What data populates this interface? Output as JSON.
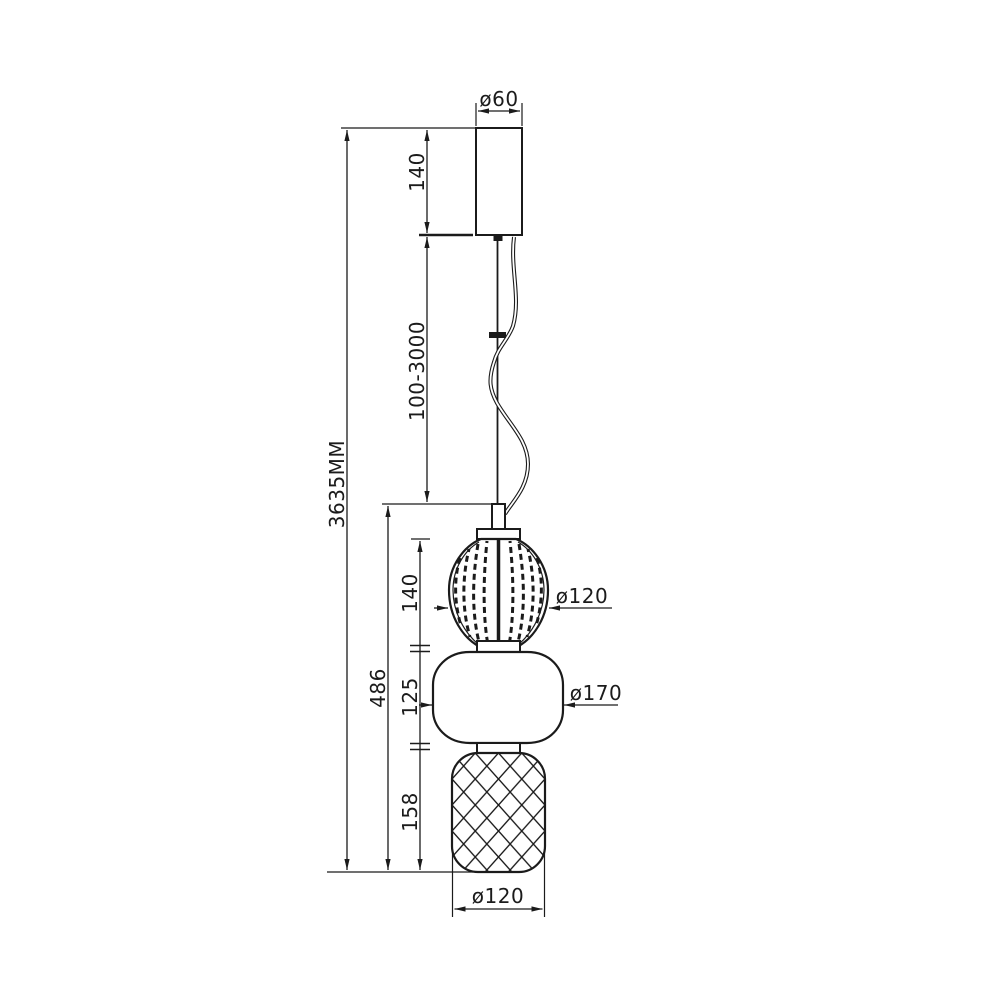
{
  "drawing": {
    "title": "pendant-lamp-dimension-drawing",
    "colors": {
      "line": "#1b1b1b",
      "background": "#ffffff"
    },
    "labels": {
      "canopy_diameter": "ø60",
      "canopy_height": "140",
      "cord_length": "100-3000",
      "overall_height": "3635MM",
      "body_height": "486",
      "top_shade_height": "140",
      "middle_shade_height": "125",
      "bottom_shade_height": "158",
      "top_shade_diameter": "ø120",
      "middle_shade_diameter": "ø170",
      "bottom_shade_diameter": "ø120"
    }
  }
}
